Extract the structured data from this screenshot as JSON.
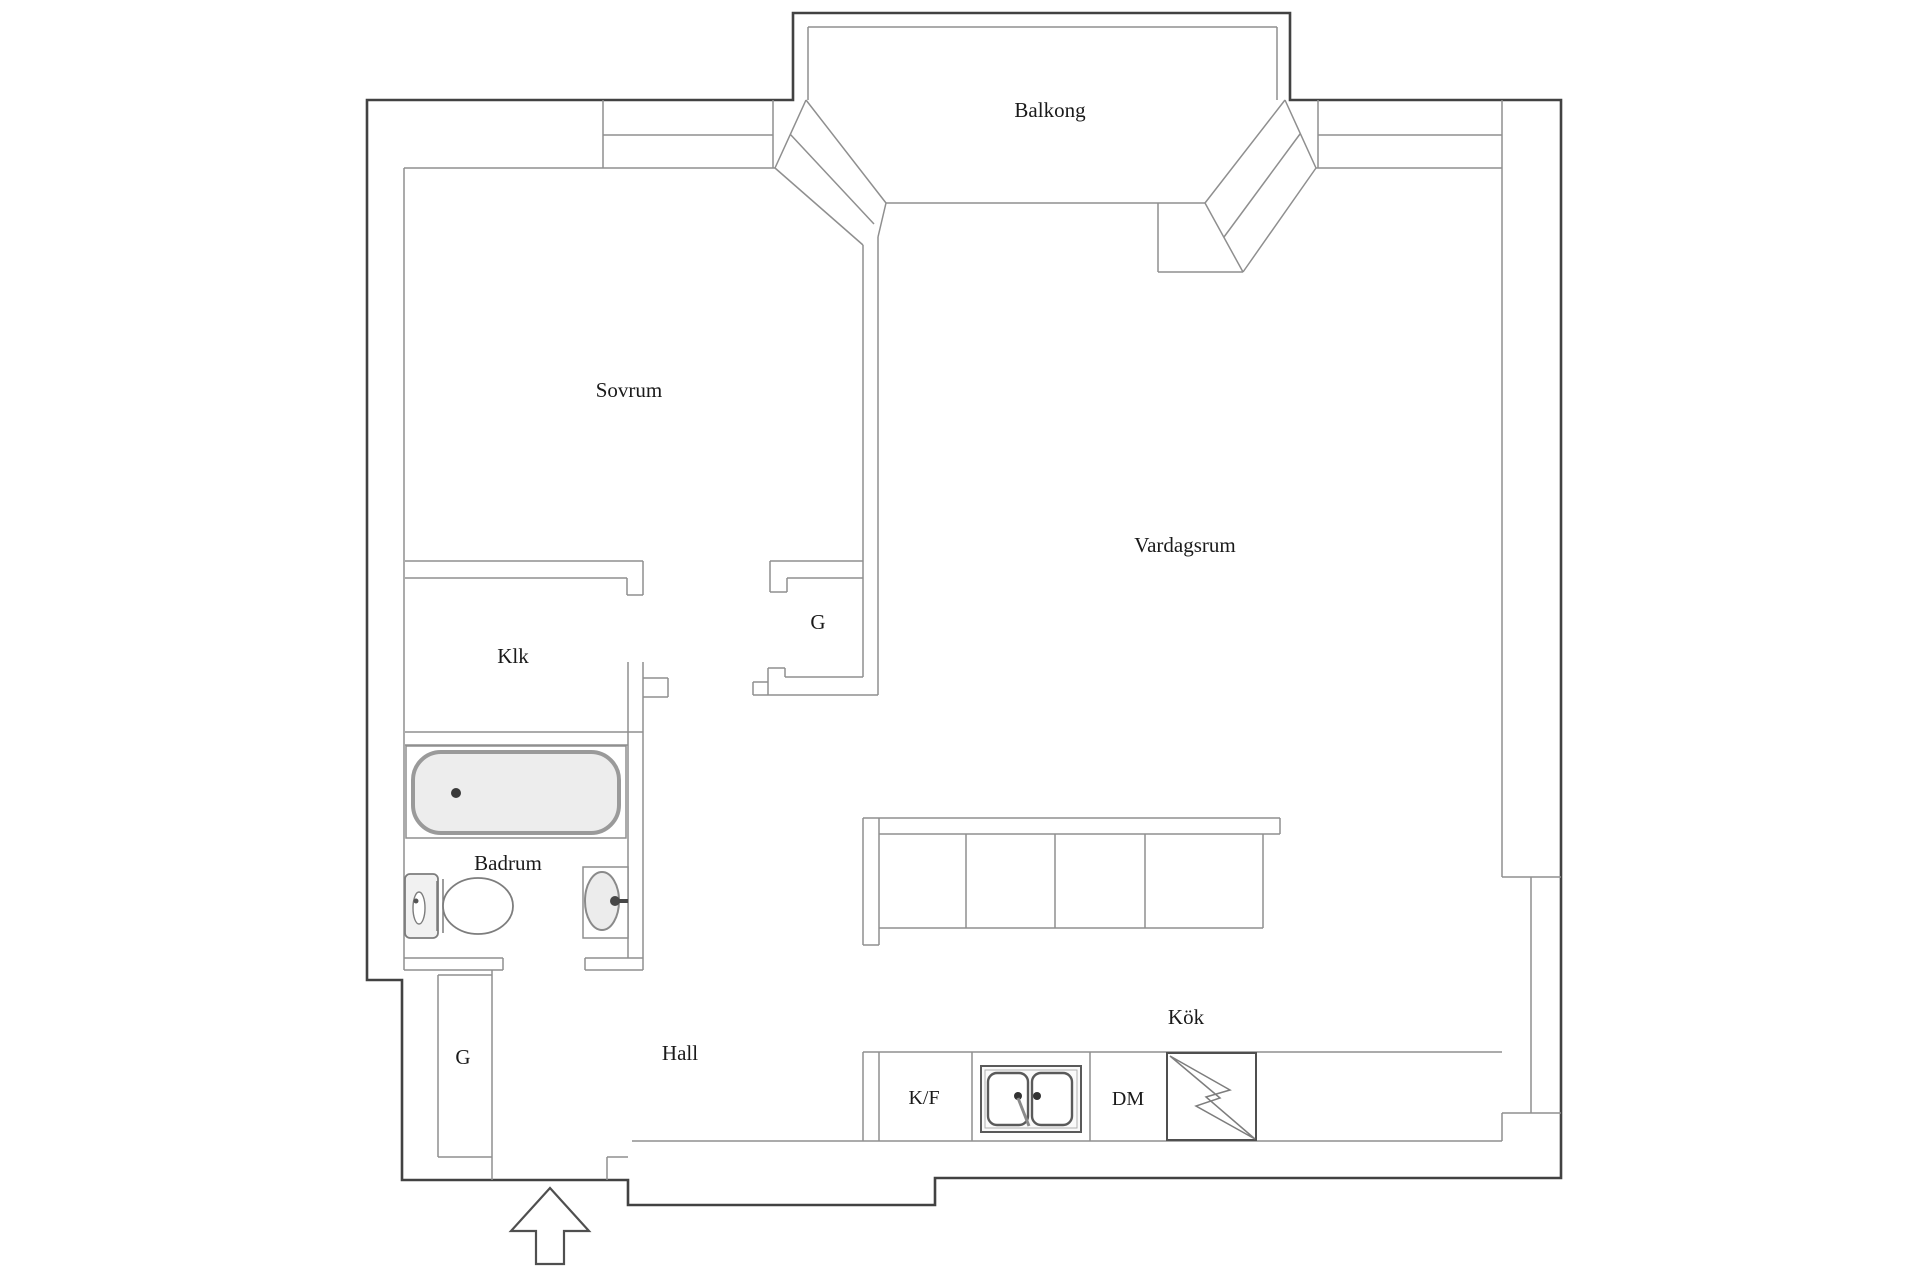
{
  "plan": {
    "rooms": [
      {
        "id": "balkong",
        "label": "Balkong"
      },
      {
        "id": "sovrum",
        "label": "Sovrum"
      },
      {
        "id": "vardagsrum",
        "label": "Vardagsrum"
      },
      {
        "id": "klk",
        "label": "Klk"
      },
      {
        "id": "garderob-inner",
        "label": "G"
      },
      {
        "id": "badrum",
        "label": "Badrum"
      },
      {
        "id": "garderob-hall",
        "label": "G"
      },
      {
        "id": "hall",
        "label": "Hall"
      },
      {
        "id": "kok",
        "label": "Kök"
      }
    ],
    "appliances": [
      {
        "id": "fridge-freezer",
        "label": "K/F"
      },
      {
        "id": "dishwasher",
        "label": "DM"
      }
    ],
    "fixtures": [
      "bathtub",
      "toilet",
      "washbasin",
      "double-kitchen-sink",
      "electric-stove",
      "entrance-arrow"
    ],
    "colors": {
      "wall_outer": "#424242",
      "wall_inner": "#8f8f8f",
      "fixture_stroke": "#7d7d7d",
      "text": "#1a1a1a",
      "fill_light": "#ededed"
    }
  }
}
